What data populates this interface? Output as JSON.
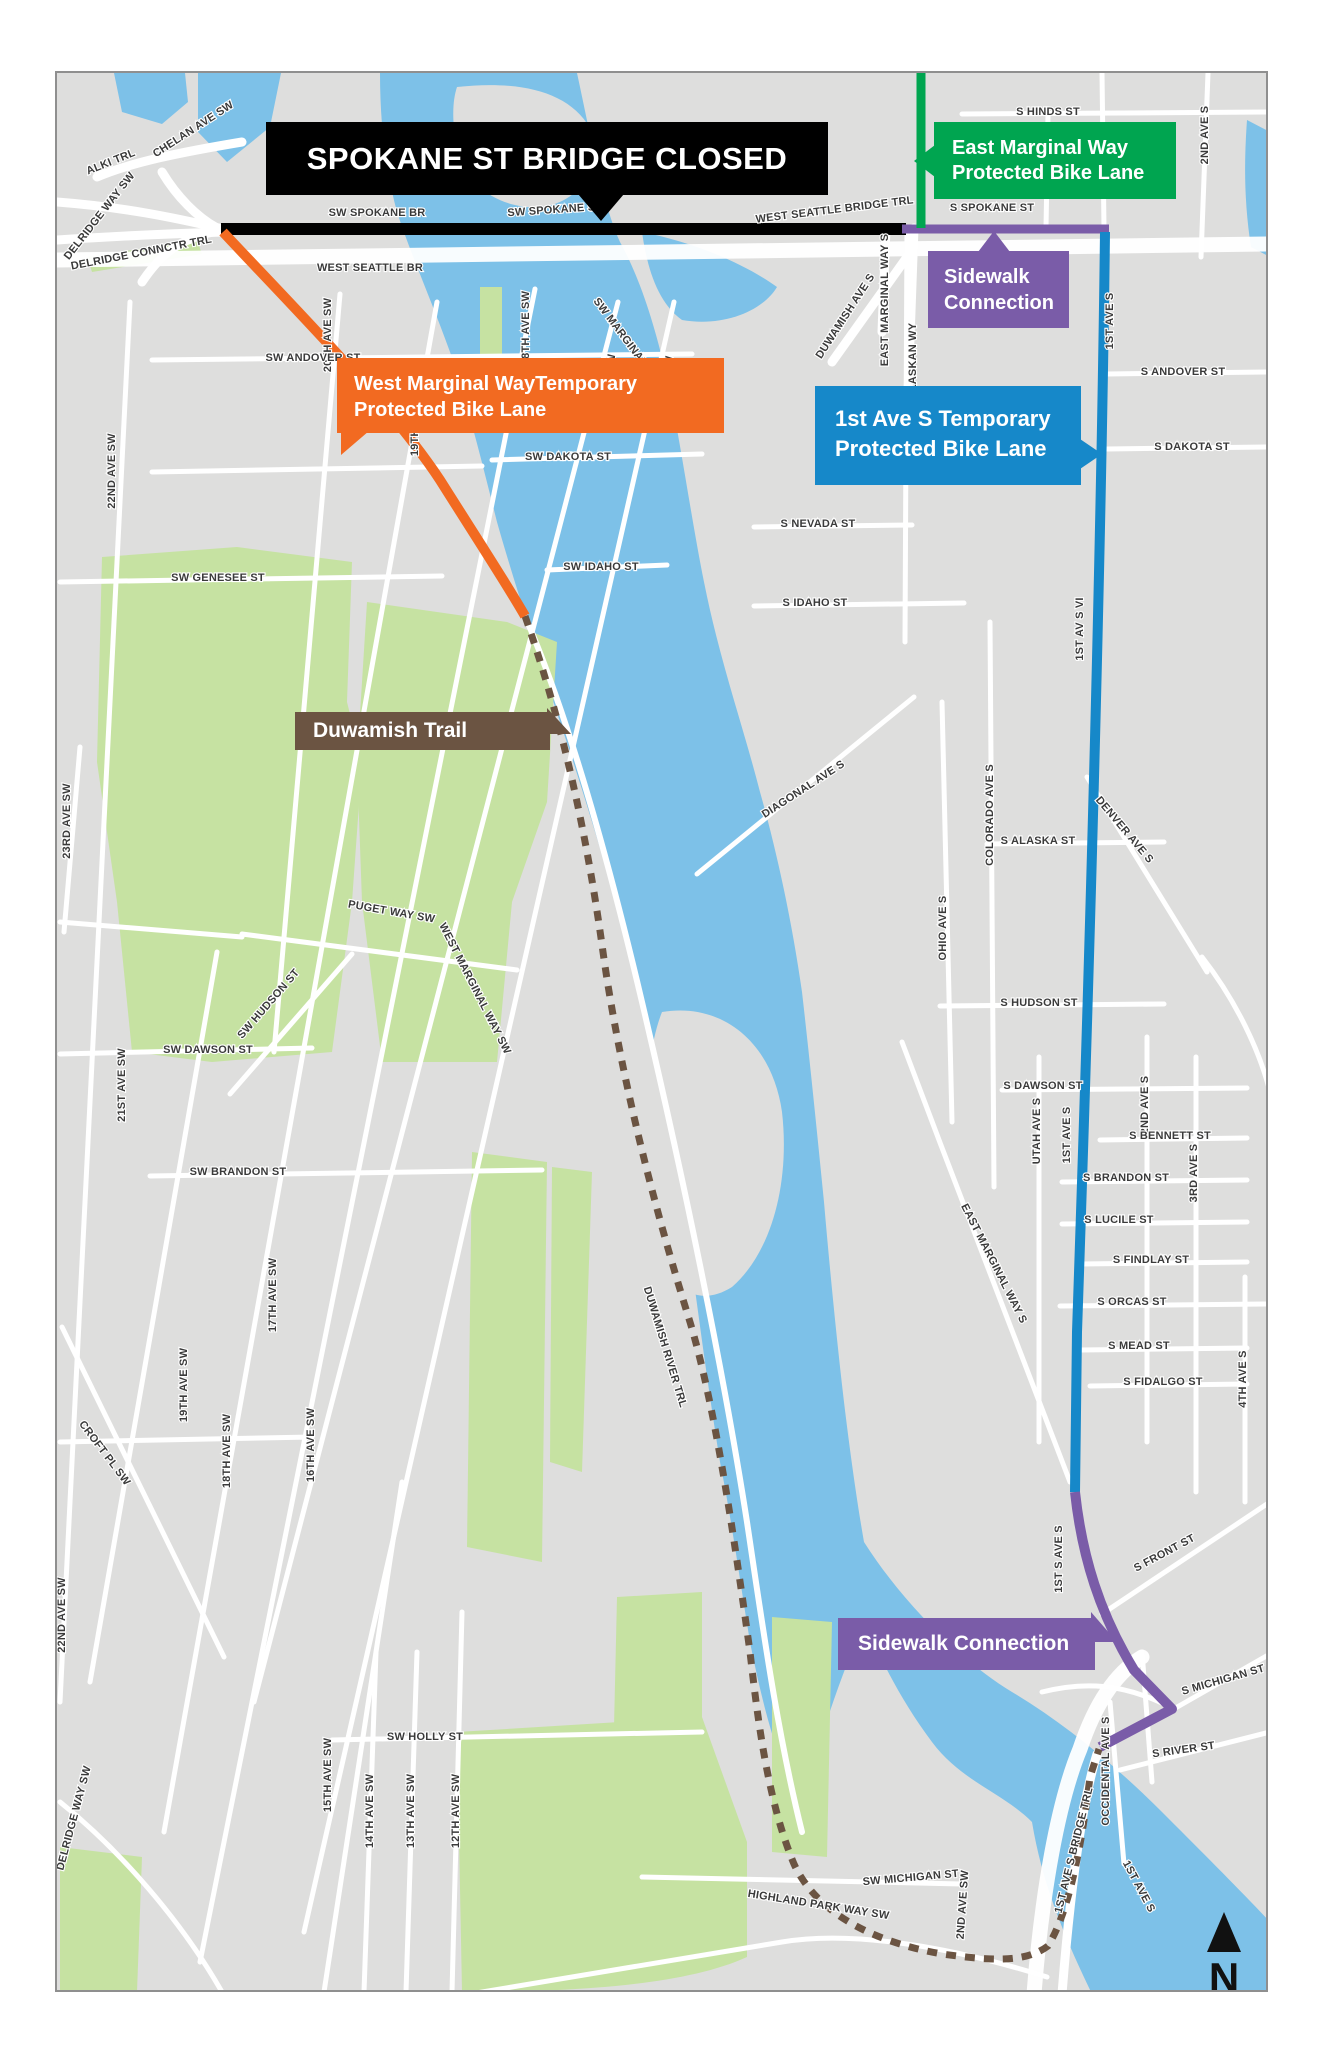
{
  "banner": {
    "label": "SPOKANE ST BRIDGE CLOSED"
  },
  "callouts": {
    "east_marginal": {
      "line1": "East Marginal Way",
      "line2": "Protected Bike Lane"
    },
    "sidewalk_north": {
      "line1": "Sidewalk",
      "line2": "Connection"
    },
    "west_marginal": {
      "line1": "West Marginal WayTemporary",
      "line2": "Protected Bike Lane"
    },
    "first_ave_s": {
      "line1": "1st Ave S Temporary",
      "line2": "Protected Bike Lane"
    },
    "duwamish_trail": {
      "line1": "Duwamish Trail"
    },
    "sidewalk_south": {
      "line1": "Sidewalk Connection"
    }
  },
  "compass": {
    "label": "N"
  },
  "colors": {
    "route_black": "#000000",
    "route_orange": "#F26A21",
    "route_green": "#00A550",
    "route_blue": "#1688C9",
    "route_purple": "#7A5CA8",
    "trail_brown": "#6B5442",
    "water": "#7DC1E8",
    "park": "#C6E2A2",
    "land": "#DEDEDD",
    "road": "#FFFFFF",
    "street_label": "#3a3a3a"
  },
  "street_labels": [
    {
      "t": "CHELAN AVE SW",
      "x": 193,
      "y": 130,
      "r": -33
    },
    {
      "t": "ALKI TRL",
      "x": 110,
      "y": 163,
      "r": -22
    },
    {
      "t": "DELRIDGE WAY SW",
      "x": 100,
      "y": 216,
      "r": -52
    },
    {
      "t": "DELRIDGE CONNCTR TRL",
      "x": 140,
      "y": 254,
      "r": -11
    },
    {
      "t": "SW SPOKANE BR",
      "x": 375,
      "y": 214,
      "r": 0
    },
    {
      "t": "SW SPOKANE ST",
      "x": 553,
      "y": 211,
      "r": -4
    },
    {
      "t": "WEST SEATTLE BR",
      "x": 368,
      "y": 269,
      "r": 0
    },
    {
      "t": "WEST SEATTLE BRIDGE TRL",
      "x": 833,
      "y": 211,
      "r": -7
    },
    {
      "t": "S SPOKANE ST",
      "x": 990,
      "y": 209,
      "r": 0
    },
    {
      "t": "S HINDS ST",
      "x": 1046,
      "y": 113,
      "r": 0
    },
    {
      "t": "2ND AVE S",
      "x": 1206,
      "y": 133,
      "r": -90
    },
    {
      "t": "DUWAMISH AVE S",
      "x": 846,
      "y": 316,
      "r": -57
    },
    {
      "t": "EAST MARGINAL WAY S",
      "x": 886,
      "y": 298,
      "r": -90
    },
    {
      "t": "ALASKAN WY",
      "x": 914,
      "y": 359,
      "r": -90
    },
    {
      "t": "1ST AVE S",
      "x": 1111,
      "y": 319,
      "r": -90
    },
    {
      "t": "S ANDOVER ST",
      "x": 1181,
      "y": 373,
      "r": 0
    },
    {
      "t": "S DAKOTA ST",
      "x": 1190,
      "y": 448,
      "r": 0
    },
    {
      "t": "S NEVADA ST",
      "x": 816,
      "y": 525,
      "r": 0
    },
    {
      "t": "S IDAHO ST",
      "x": 813,
      "y": 604,
      "r": 0
    },
    {
      "t": "1ST AV S VI",
      "x": 1081,
      "y": 627,
      "r": -90
    },
    {
      "t": "DIAGONAL AVE S",
      "x": 803,
      "y": 790,
      "r": -33
    },
    {
      "t": "COLORADO AVE S",
      "x": 991,
      "y": 813,
      "r": -90
    },
    {
      "t": "S ALASKA ST",
      "x": 1036,
      "y": 842,
      "r": 0
    },
    {
      "t": "DENVER AVE S",
      "x": 1120,
      "y": 830,
      "r": 50
    },
    {
      "t": "OHIO AVE S",
      "x": 944,
      "y": 926,
      "r": -90
    },
    {
      "t": "S HUDSON ST",
      "x": 1037,
      "y": 1004,
      "r": 0
    },
    {
      "t": "S DAWSON ST",
      "x": 1041,
      "y": 1087,
      "r": 0
    },
    {
      "t": "UTAH AVE S",
      "x": 1038,
      "y": 1129,
      "r": -90
    },
    {
      "t": "1ST AVE S",
      "x": 1068,
      "y": 1133,
      "r": -90
    },
    {
      "t": "2ND AVE S",
      "x": 1146,
      "y": 1103,
      "r": -90
    },
    {
      "t": "S BENNETT ST",
      "x": 1168,
      "y": 1137,
      "r": 0
    },
    {
      "t": "3RD AVE S",
      "x": 1195,
      "y": 1171,
      "r": -90
    },
    {
      "t": "S BRANDON ST",
      "x": 1124,
      "y": 1179,
      "r": 0
    },
    {
      "t": "S LUCILE ST",
      "x": 1117,
      "y": 1221,
      "r": 0
    },
    {
      "t": "S FINDLAY ST",
      "x": 1149,
      "y": 1261,
      "r": 0
    },
    {
      "t": "S ORCAS ST",
      "x": 1130,
      "y": 1303,
      "r": 0
    },
    {
      "t": "S MEAD ST",
      "x": 1137,
      "y": 1347,
      "r": 0
    },
    {
      "t": "S FIDALGO ST",
      "x": 1161,
      "y": 1383,
      "r": 0
    },
    {
      "t": "4TH AVE S",
      "x": 1244,
      "y": 1377,
      "r": -90
    },
    {
      "t": "EAST MARGINAL WAY S",
      "x": 989,
      "y": 1263,
      "r": 63
    },
    {
      "t": "1ST S AVE S",
      "x": 1060,
      "y": 1557,
      "r": -90
    },
    {
      "t": "S FRONT ST",
      "x": 1164,
      "y": 1554,
      "r": -28
    },
    {
      "t": "S MICHIGAN ST",
      "x": 1222,
      "y": 1681,
      "r": -16
    },
    {
      "t": "S RIVER ST",
      "x": 1182,
      "y": 1751,
      "r": -8
    },
    {
      "t": "OCCIDENTAL AVE S",
      "x": 1107,
      "y": 1769,
      "r": -90
    },
    {
      "t": "1ST AVE S BRIDGE TRL",
      "x": 1075,
      "y": 1849,
      "r": -76
    },
    {
      "t": "SW MARGINAL PL",
      "x": 621,
      "y": 339,
      "r": 53
    },
    {
      "t": "20TH AVE SW",
      "x": 329,
      "y": 333,
      "r": -90
    },
    {
      "t": "18TH AVE SW",
      "x": 527,
      "y": 326,
      "r": -90
    },
    {
      "t": "17TH AVE SW",
      "x": 613,
      "y": 389,
      "r": -90
    },
    {
      "t": "16TH AVE SW",
      "x": 669,
      "y": 391,
      "r": -87
    },
    {
      "t": "SW ANDOVER ST",
      "x": 311,
      "y": 359,
      "r": 0
    },
    {
      "t": "19TH AVE SW",
      "x": 416,
      "y": 417,
      "r": -90
    },
    {
      "t": "22ND AVE SW",
      "x": 113,
      "y": 469,
      "r": -90
    },
    {
      "t": "SW DAKOTA ST",
      "x": 566,
      "y": 458,
      "r": 0
    },
    {
      "t": "SW GENESEE ST",
      "x": 216,
      "y": 579,
      "r": 0
    },
    {
      "t": "SW IDAHO ST",
      "x": 599,
      "y": 568,
      "r": 0
    },
    {
      "t": "23RD AVE SW",
      "x": 68,
      "y": 819,
      "r": -90
    },
    {
      "t": "PUGET WAY SW",
      "x": 389,
      "y": 913,
      "r": 10
    },
    {
      "t": "WEST MARGINAL WAY SW",
      "x": 470,
      "y": 988,
      "r": 63
    },
    {
      "t": "SW HUDSON ST",
      "x": 269,
      "y": 1004,
      "r": -49
    },
    {
      "t": "SW DAWSON ST",
      "x": 206,
      "y": 1051,
      "r": 0
    },
    {
      "t": "21ST AVE SW",
      "x": 123,
      "y": 1083,
      "r": -90
    },
    {
      "t": "SW BRANDON ST",
      "x": 236,
      "y": 1173,
      "r": 0
    },
    {
      "t": "DUWAMISH RIVER TRL",
      "x": 660,
      "y": 1346,
      "r": 73
    },
    {
      "t": "19TH AVE SW",
      "x": 185,
      "y": 1383,
      "r": -90
    },
    {
      "t": "17TH AVE SW",
      "x": 274,
      "y": 1293,
      "r": -90
    },
    {
      "t": "CROFT PL SW",
      "x": 100,
      "y": 1453,
      "r": 53
    },
    {
      "t": "18TH AVE SW",
      "x": 228,
      "y": 1449,
      "r": -90
    },
    {
      "t": "16TH AVE SW",
      "x": 312,
      "y": 1443,
      "r": -90
    },
    {
      "t": "22ND AVE SW",
      "x": 63,
      "y": 1613,
      "r": -90
    },
    {
      "t": "SW HOLLY ST",
      "x": 423,
      "y": 1738,
      "r": 0
    },
    {
      "t": "15TH AVE SW",
      "x": 329,
      "y": 1773,
      "r": -90
    },
    {
      "t": "14TH AVE SW",
      "x": 371,
      "y": 1809,
      "r": -90
    },
    {
      "t": "13TH AVE SW",
      "x": 412,
      "y": 1809,
      "r": -90
    },
    {
      "t": "12TH AVE SW",
      "x": 457,
      "y": 1809,
      "r": -90
    },
    {
      "t": "DELRIDGE WAY SW",
      "x": 75,
      "y": 1817,
      "r": -75
    },
    {
      "t": "SW MICHIGAN ST",
      "x": 909,
      "y": 1879,
      "r": -5
    },
    {
      "t": "HIGHLAND PARK WAY SW",
      "x": 816,
      "y": 1906,
      "r": 9
    },
    {
      "t": "2ND AVE SW",
      "x": 964,
      "y": 1903,
      "r": -86
    },
    {
      "t": "1ST AVE S",
      "x": 1134,
      "y": 1886,
      "r": 62
    }
  ]
}
